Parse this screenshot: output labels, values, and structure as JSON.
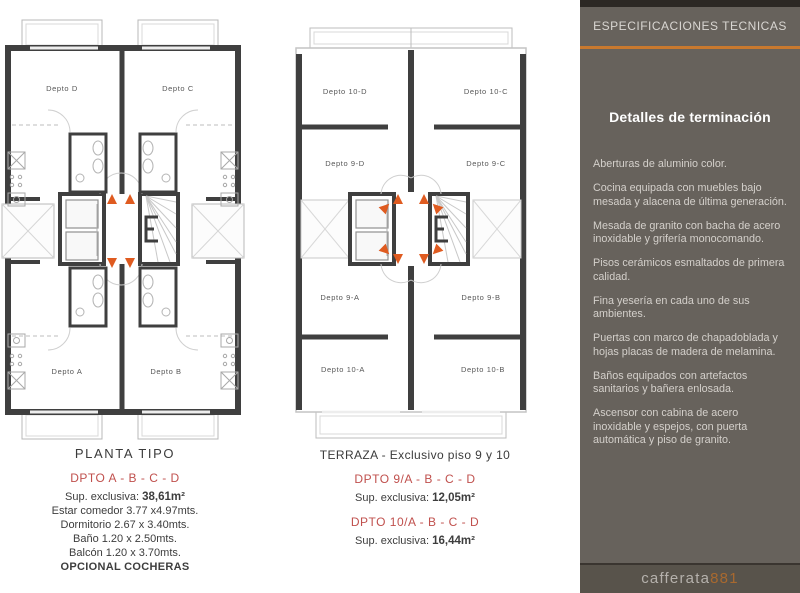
{
  "plan_left": {
    "caption": "PLANTA TIPO",
    "rooms": {
      "tl": "Depto D",
      "tr": "Depto C",
      "bl": "Depto A",
      "br": "Depto B"
    },
    "details": {
      "title": "DPTO A - B - C - D",
      "sup_label": "Sup. exclusiva: ",
      "sup_value": "38,61m²",
      "line1": "Estar comedor 3.77 x4.97mts.",
      "line2": "Dormitorio 2.67 x 3.40mts.",
      "line3": "Baño 1.20 x 2.50mts.",
      "line4": "Balcón 1.20 x 3.70mts.",
      "footer": "OPCIONAL COCHERAS"
    }
  },
  "plan_right": {
    "caption": "TERRAZA - Exclusivo piso 9 y 10",
    "rooms": {
      "tl": "Depto 10-D",
      "tr": "Depto 10-C",
      "ml": "Depto 9-D",
      "mr": "Depto 9-C",
      "bl2": "Depto 9-A",
      "br2": "Depto 9-B",
      "bl": "Depto 10-A",
      "br": "Depto 10-B"
    },
    "details": {
      "title9": "DPTO 9/A - B - C - D",
      "sup9_label": "Sup. exclusiva: ",
      "sup9_value": "12,05m²",
      "title10": "DPTO 10/A - B - C - D",
      "sup10_label": "Sup. exclusiva: ",
      "sup10_value": "16,44m²"
    }
  },
  "panel": {
    "header": "ESPECIFICACIONES TECNICAS",
    "title": "Detalles de terminación",
    "items": [
      "Aberturas de aluminio color.",
      "Cocina equipada con muebles bajo mesada y alacena de última generación.",
      "Mesada de granito con bacha de acero inoxidable y grifería monocomando.",
      "Pisos cerámicos esmaltados de primera calidad.",
      "Fina yesería en cada uno de sus ambientes.",
      "Puertas con marco de chapadoblada y hojas placas de madera de melamina.",
      "Baños equipados con artefactos sanitarios y bañera enlosada.",
      "Ascensor con cabina de acero inoxidable y espejos, con puerta automática y piso de granito."
    ],
    "logo_name": "cafferata",
    "logo_number": "881"
  },
  "colors": {
    "wall": "#3f3f3f",
    "accent": "#c9792f",
    "triangle": "#df5b20",
    "dpto_red": "#c0504d",
    "panel_bg": "#67625c"
  }
}
